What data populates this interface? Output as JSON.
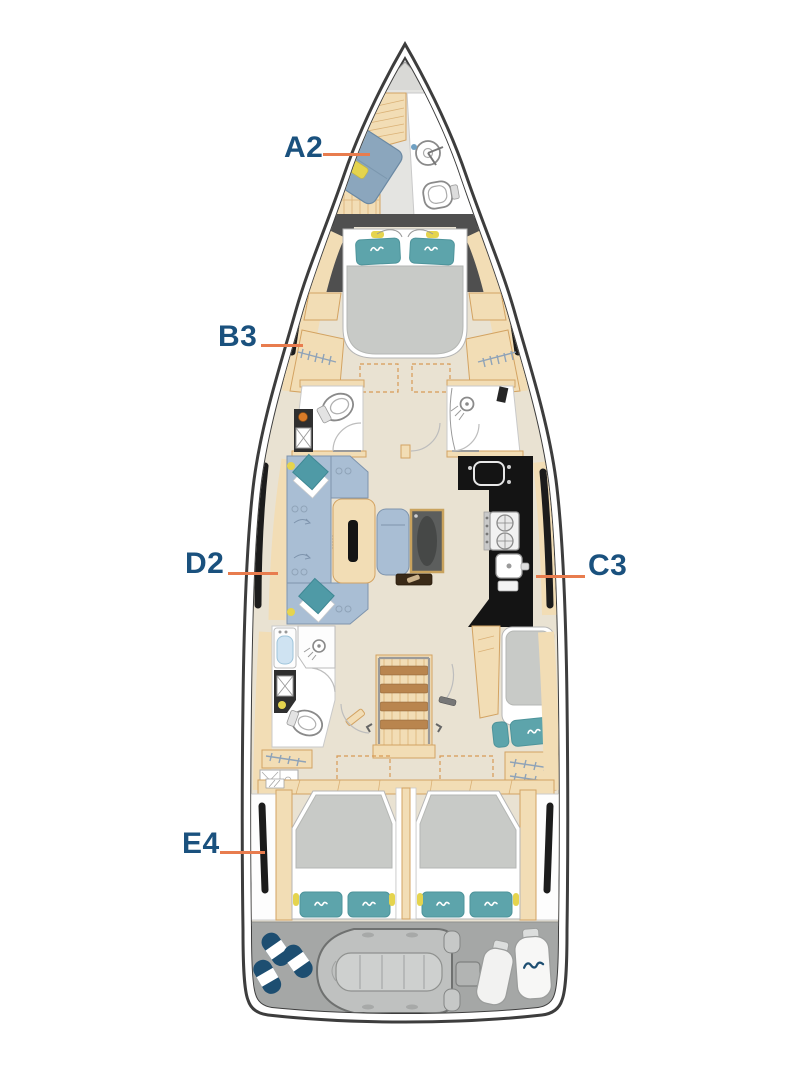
{
  "diagram": {
    "type": "sailing-yacht-deck-layout-plan",
    "labels": [
      {
        "code": "A2"
      },
      {
        "code": "B3"
      },
      {
        "code": "D2"
      },
      {
        "code": "C3"
      },
      {
        "code": "E4"
      }
    ]
  },
  "colors": {
    "label-text": "#1a517e",
    "leader-line": "#e87c4e",
    "hull-outline": "#3d3d3d",
    "wood": "#f2ddb5",
    "wood-stroke": "#d3a362",
    "floor": "#e9e2d2",
    "sofa-blue": "#a9bed4",
    "pillow-teal": "#5da4ab",
    "cushion-teal": "#4f9aa6",
    "accent-yellow": "#e5d44e",
    "bed-gray": "#c8cac7",
    "bulkhead-gray": "#4f4f4f",
    "galley-black": "#141414",
    "transom-gray": "#a5a7a6",
    "fender-navy": "#1d4e71"
  }
}
